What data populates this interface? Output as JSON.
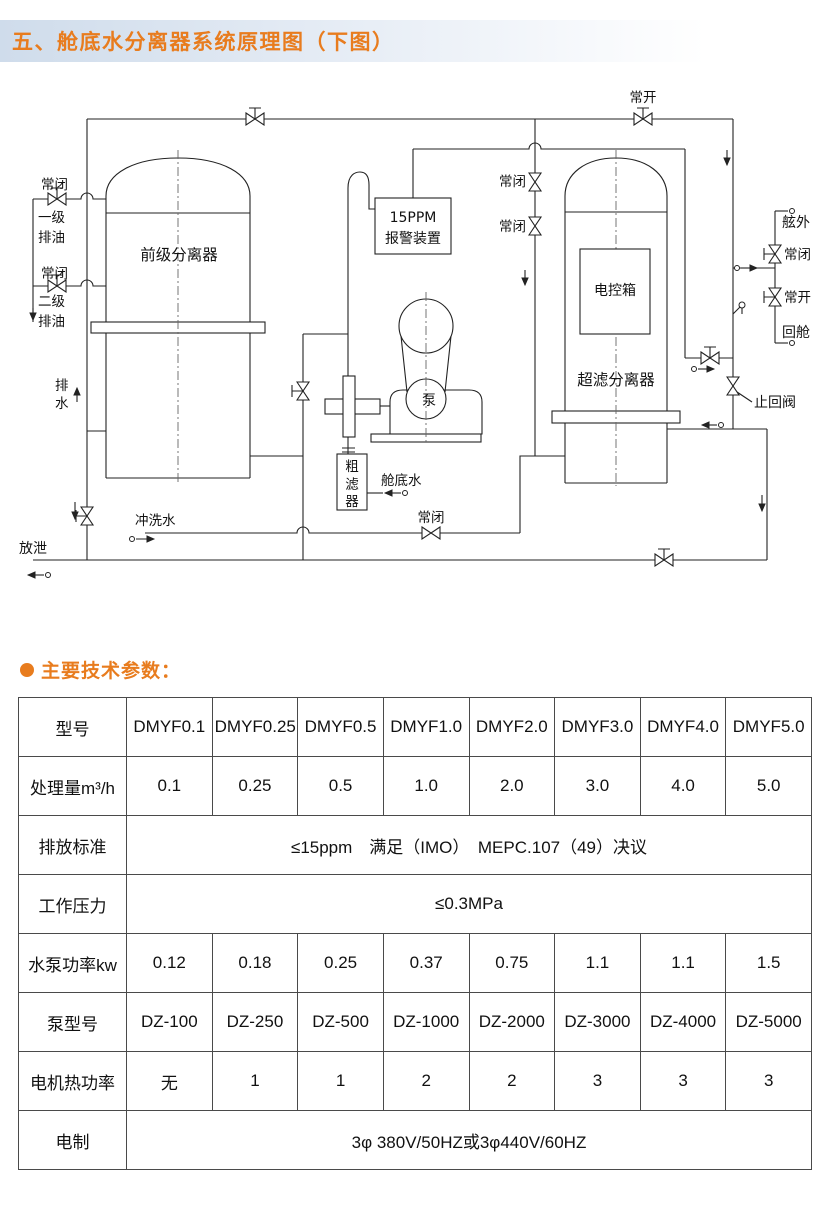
{
  "page": {
    "title": "五、舱底水分离器系统原理图（下图）",
    "params_heading": "主要技术参数：",
    "accent_color": "#e87c1e"
  },
  "diagram": {
    "labels": {
      "nc_oil1": "常闭",
      "oil1_a": "一级",
      "oil1_b": "排油",
      "nc_oil2": "常闭",
      "oil2_a": "二级",
      "oil2_b": "排油",
      "pre_separator": "前级分离器",
      "drain_a": "排",
      "drain_b": "水",
      "vent": "放泄",
      "flush_water": "冲洗水",
      "nc_flush": "常闭",
      "filter_a": "粗",
      "filter_b": "滤",
      "filter_c": "器",
      "bilge_water": "舱底水",
      "pump": "泵",
      "alarm_a": "15PPM",
      "alarm_b": "报警装置",
      "nc_mid1": "常闭",
      "nc_mid2": "常闭",
      "no_top": "常开",
      "control_box": "电控箱",
      "ultra_separator": "超滤分离器",
      "outboard": "舷外",
      "nc_overboard": "常闭",
      "no_return": "常开",
      "return_cabin": "回舱",
      "check_valve": "止回阀"
    }
  },
  "table": {
    "rows": [
      {
        "label": "型号",
        "cells": [
          "DMYF0.1",
          "DMYF0.25",
          "DMYF0.5",
          "DMYF1.0",
          "DMYF2.0",
          "DMYF3.0",
          "DMYF4.0",
          "DMYF5.0"
        ]
      },
      {
        "label": "处理量m³/h",
        "cells": [
          "0.1",
          "0.25",
          "0.5",
          "1.0",
          "2.0",
          "3.0",
          "4.0",
          "5.0"
        ]
      },
      {
        "label": "排放标准",
        "span": "≤15ppm　满足（IMO）　MEPC.107（49）决议"
      },
      {
        "label": "工作压力",
        "span": "≤0.3MPa"
      },
      {
        "label": "水泵功率kw",
        "cells": [
          "0.12",
          "0.18",
          "0.25",
          "0.37",
          "0.75",
          "1.1",
          "1.1",
          "1.5"
        ]
      },
      {
        "label": "泵型号",
        "cells": [
          "DZ-100",
          "DZ-250",
          "DZ-500",
          "DZ-1000",
          "DZ-2000",
          "DZ-3000",
          "DZ-4000",
          "DZ-5000"
        ]
      },
      {
        "label": "电机热功率",
        "cells": [
          "无",
          "1",
          "1",
          "2",
          "2",
          "3",
          "3",
          "3"
        ]
      },
      {
        "label": "电制",
        "span": "3φ 380V/50HZ或3φ440V/60HZ"
      }
    ]
  }
}
